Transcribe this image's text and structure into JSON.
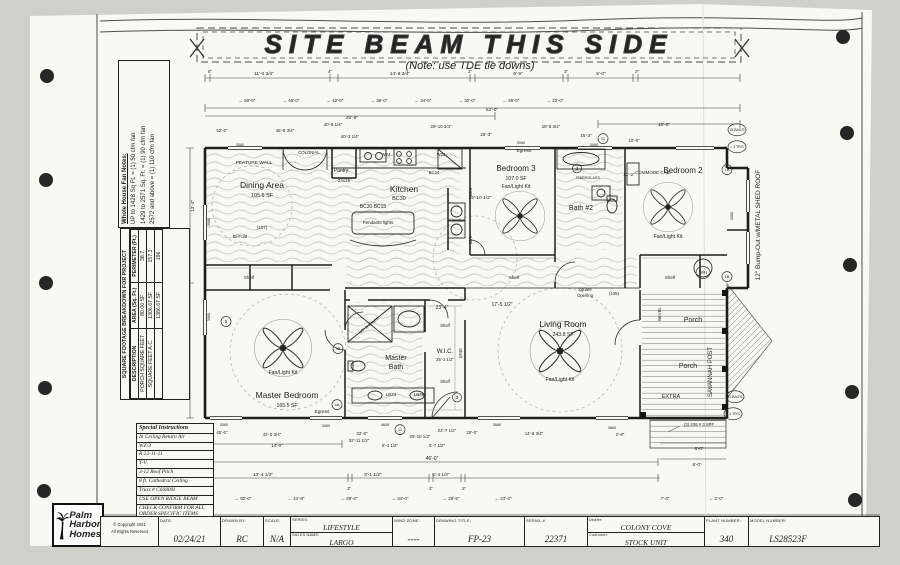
{
  "banner": {
    "title": "SITE BEAM THIS SIDE",
    "note": "(Note: use TDE tie downs)"
  },
  "fan_notes": {
    "title": "Whole House Fan Notes:",
    "line1": "UP to 1428 Sq Ft. = (1) 50 cfm fan",
    "line2": "1429 to 2571 Sq. Ft. = (1) 90 cfm fan",
    "line3": "2572 and above = (1) 110 cfm fan"
  },
  "sqft_table": {
    "title": "SQUARE FOOTAGE BREAKDOWN FOR PROJECT",
    "col1": "DESCRIPTION",
    "col2": "AREA (Sq. Ft.)",
    "col3": "PERIMETER (Ft.)",
    "r1c1": "PORCH SQUARE FEET",
    "r1c2": "80.00 SF",
    "r1c3": "38.7",
    "r2c1": "SQUARE FEET A.C.",
    "r2c2": "1306.67 SF",
    "r2c3": "157.3",
    "r3c1": "",
    "r3c2": "1386.67 SF",
    "r3c3": "196"
  },
  "special_instructions": {
    "title": "Special Instructions",
    "i1": "In Ceiling Return Air",
    "i2": "WZ-3",
    "i3": "R 22-11-11",
    "i4": "T-V",
    "i5": "3-12 Roof Pitch",
    "i6": "8 ft. Cathedral Ceiling",
    "i7": "Truss # C66800I",
    "i8": "USE OPEN RIDGE BEAM",
    "i9": "CHECK CONFIRM FOR ALL ORDER SPECIFIC ITEMS"
  },
  "logo": {
    "l1": "Palm",
    "l2": "Harbor",
    "l3": "Homes"
  },
  "copyright": {
    "l1": "© Copyright 2021",
    "l2": "All Rights Reserved"
  },
  "title_block": {
    "date_label": "DATE:",
    "date": "02/24/21",
    "drawn_label": "DRAWN BY:",
    "drawn": "RC",
    "scale_label": "SCALE:",
    "scale": "N/A",
    "series_label": "SERIES:",
    "series": "LIFESTYLE",
    "sales_label": "SALES NAME:",
    "sales": "LARGO",
    "wind_label": "WIND ZONE:",
    "wind": "----",
    "dtitle_label": "DRAWING TITLE:",
    "dtitle": "FP-23",
    "serial_label": "SERIAL #",
    "serial": "22371",
    "dealer_label": "Dealer:",
    "dealer": "COLONY COVE",
    "customer_label": "Customer:",
    "customer": "STOCK UNIT",
    "plant_label": "PLANT NUMBER:",
    "plant": "340",
    "model_label": "MODEL NUMBER:",
    "model": "LS28523F"
  },
  "plan_labels": [
    {
      "t": "Dining Area",
      "x": 262,
      "y": 188,
      "s": 8.5
    },
    {
      "t": "105.6 SF",
      "x": 262,
      "y": 197,
      "s": 5.5
    },
    {
      "t": "FEATURE WALL",
      "x": 254,
      "y": 164,
      "s": 4.8
    },
    {
      "t": "COLONIAL",
      "x": 309,
      "y": 154,
      "s": 4.2
    },
    {
      "t": "Pantry",
      "x": 341,
      "y": 172,
      "s": 5
    },
    {
      "t": "Kitchen",
      "x": 404,
      "y": 192,
      "s": 8.5
    },
    {
      "t": "BC30",
      "x": 399,
      "y": 200,
      "s": 5.5
    },
    {
      "t": "BC30 BC15",
      "x": 373,
      "y": 208,
      "s": 5
    },
    {
      "t": "Pendants lights",
      "x": 378,
      "y": 224,
      "s": 4.5
    },
    {
      "t": "24x26",
      "x": 344,
      "y": 182,
      "s": 4.5
    },
    {
      "t": "W24",
      "x": 386,
      "y": 156,
      "s": 4.2
    },
    {
      "t": "W24",
      "x": 441,
      "y": 156,
      "s": 4.2
    },
    {
      "t": "BC24",
      "x": 434,
      "y": 174,
      "s": 4.2
    },
    {
      "t": "W30",
      "x": 469,
      "y": 192,
      "s": 4.2,
      "r": 90
    },
    {
      "t": "W30",
      "x": 469,
      "y": 240,
      "s": 4.2,
      "r": 90
    },
    {
      "t": "Bi-Fold",
      "x": 240,
      "y": 238,
      "s": 4.5
    },
    {
      "t": "(107)",
      "x": 262,
      "y": 229,
      "s": 4.5
    },
    {
      "t": "Egress",
      "x": 524,
      "y": 152,
      "s": 4.8
    },
    {
      "t": "Bedroom 3",
      "x": 516,
      "y": 171,
      "s": 8
    },
    {
      "t": "107.0 SF",
      "x": 516,
      "y": 180,
      "s": 5.2
    },
    {
      "t": "Fan/Light Kit",
      "x": 516,
      "y": 188,
      "s": 5.2
    },
    {
      "t": "Bath #2",
      "x": 581,
      "y": 210,
      "s": 7
    },
    {
      "t": "2",
      "x": 577,
      "y": 170,
      "s": 4.5,
      "c": 4.5
    },
    {
      "t": "FIBERGLASS",
      "x": 588,
      "y": 179,
      "s": 3.8
    },
    {
      "t": "COMMODE CAB.",
      "x": 653,
      "y": 174,
      "s": 4.5
    },
    {
      "t": "Bedroom 2",
      "x": 683,
      "y": 173,
      "s": 8
    },
    {
      "t": "Fan/Light Kit",
      "x": 668,
      "y": 238,
      "s": 5.2
    },
    {
      "t": "Shelf",
      "x": 249,
      "y": 279,
      "s": 4.5
    },
    {
      "t": "Shelf",
      "x": 514,
      "y": 279,
      "s": 4.5
    },
    {
      "t": "Shelf",
      "x": 670,
      "y": 279,
      "s": 4.5
    },
    {
      "t": "W/H",
      "x": 703,
      "y": 274,
      "s": 4.2,
      "c": 7
    },
    {
      "t": "Master Bedroom",
      "x": 287,
      "y": 398,
      "s": 8.5
    },
    {
      "t": "165.5 SF",
      "x": 287,
      "y": 407,
      "s": 5.2
    },
    {
      "t": "Fan/Light Kit",
      "x": 283,
      "y": 374,
      "s": 5.2
    },
    {
      "t": "Egress",
      "x": 322,
      "y": 413,
      "s": 4.8
    },
    {
      "t": "Master",
      "x": 396,
      "y": 360,
      "s": 7
    },
    {
      "t": "Bath",
      "x": 396,
      "y": 369,
      "s": 7
    },
    {
      "t": "60\" SHOWER",
      "x": 370,
      "y": 326,
      "s": 3.8,
      "r": -38
    },
    {
      "t": "LB24",
      "x": 391,
      "y": 396,
      "s": 4.5
    },
    {
      "t": "LB36",
      "x": 419,
      "y": 396,
      "s": 4.5
    },
    {
      "t": "W.I.C.",
      "x": 445,
      "y": 353,
      "s": 6
    },
    {
      "t": "25'-1 1/2\"",
      "x": 445,
      "y": 361,
      "s": 4.2
    },
    {
      "t": "Shelf",
      "x": 445,
      "y": 327,
      "s": 4.2
    },
    {
      "t": "Shelf",
      "x": 445,
      "y": 383,
      "s": 4.2
    },
    {
      "t": "Shelf",
      "x": 459,
      "y": 353,
      "s": 4.2,
      "r": 90
    },
    {
      "t": "Living Room",
      "x": 563,
      "y": 327,
      "s": 8.5
    },
    {
      "t": "243.8 SF",
      "x": 563,
      "y": 336,
      "s": 5.2
    },
    {
      "t": "Fan/Light Kit",
      "x": 560,
      "y": 381,
      "s": 5.2
    },
    {
      "t": "Square",
      "x": 585,
      "y": 291,
      "s": 4.2
    },
    {
      "t": "Opening",
      "x": 585,
      "y": 297,
      "s": 4.2
    },
    {
      "t": "(105)",
      "x": 614,
      "y": 295,
      "s": 4.2
    },
    {
      "t": "Porch",
      "x": 693,
      "y": 322,
      "s": 7
    },
    {
      "t": "Porch",
      "x": 688,
      "y": 368,
      "s": 7
    },
    {
      "t": "SAVANNAH POST",
      "x": 712,
      "y": 372,
      "s": 6,
      "r": -90
    },
    {
      "t": "BEVEL",
      "x": 661,
      "y": 314,
      "s": 4.2,
      "r": -90
    },
    {
      "t": "EXTRA",
      "x": 671,
      "y": 398,
      "s": 5.5
    },
    {
      "t": "12\" Bump-Out w/METAL SHED ROOF",
      "x": 760,
      "y": 225,
      "s": 6.5,
      "r": -90
    },
    {
      "t": "(3) 2X6 # 3 SPF",
      "x": 699,
      "y": 426,
      "s": 4.2
    },
    {
      "t": "15 BAG'S",
      "x": 737,
      "y": 131,
      "s": 3.5,
      "c": 9
    },
    {
      "t": "= 1 TR'S",
      "x": 737,
      "y": 148,
      "s": 3.5,
      "c": 9
    },
    {
      "t": "11 BAG'S",
      "x": 735,
      "y": 398,
      "s": 3.5,
      "c": 9
    },
    {
      "t": "= 1 TR'S",
      "x": 733,
      "y": 415,
      "s": 3.5,
      "c": 9
    },
    {
      "t": "1A",
      "x": 727,
      "y": 171,
      "s": 4,
      "c": 5
    },
    {
      "t": "1B",
      "x": 727,
      "y": 278,
      "s": 4,
      "c": 5
    },
    {
      "t": "5",
      "x": 226,
      "y": 323,
      "s": 4.5,
      "c": 5
    },
    {
      "t": "4B",
      "x": 338,
      "y": 350,
      "s": 4,
      "c": 5
    },
    {
      "t": "4A",
      "x": 337,
      "y": 406,
      "s": 4,
      "c": 5
    },
    {
      "t": "3",
      "x": 457,
      "y": 399,
      "s": 4.5,
      "c": 4.5
    },
    {
      "t": "11",
      "x": 603,
      "y": 140,
      "s": 4,
      "c": 5
    },
    {
      "t": "11",
      "x": 400,
      "y": 431,
      "s": 4,
      "c": 5
    },
    {
      "t": "6\"",
      "x": 210,
      "y": 73,
      "s": 4.2
    },
    {
      "t": "11'-0 3/4\"",
      "x": 264,
      "y": 75,
      "s": 4.8
    },
    {
      "t": "4\"",
      "x": 330,
      "y": 73,
      "s": 4.2
    },
    {
      "t": "14'-8 3/4\"",
      "x": 400,
      "y": 75,
      "s": 4.8
    },
    {
      "t": "3\"",
      "x": 470,
      "y": 73,
      "s": 4.2
    },
    {
      "t": "9'-9\"",
      "x": 518,
      "y": 75,
      "s": 4.8
    },
    {
      "t": "3\"",
      "x": 566,
      "y": 73,
      "s": 4.2
    },
    {
      "t": "5'-0\"",
      "x": 601,
      "y": 75,
      "s": 4.8
    },
    {
      "t": "3\"",
      "x": 637,
      "y": 73,
      "s": 4.2
    },
    {
      "t": "← 50'-0\"",
      "x": 247,
      "y": 102,
      "s": 4.4
    },
    {
      "t": "← 46'-0\"",
      "x": 291,
      "y": 102,
      "s": 4.4
    },
    {
      "t": "← 42'-0\"",
      "x": 335,
      "y": 102,
      "s": 4.4
    },
    {
      "t": "← 38'-0\"",
      "x": 379,
      "y": 102,
      "s": 4.4
    },
    {
      "t": "← 34'-0\"",
      "x": 423,
      "y": 102,
      "s": 4.4
    },
    {
      "t": "← 30'-0\"",
      "x": 467,
      "y": 102,
      "s": 4.4
    },
    {
      "t": "← 26'-0\"",
      "x": 511,
      "y": 102,
      "s": 4.4
    },
    {
      "t": "← 22'-0\"",
      "x": 555,
      "y": 102,
      "s": 4.4
    },
    {
      "t": "52'-0\"",
      "x": 492,
      "y": 111,
      "s": 4.8
    },
    {
      "t": "26'-9\"",
      "x": 352,
      "y": 119,
      "s": 4.8
    },
    {
      "t": "10'-0\"",
      "x": 664,
      "y": 126,
      "s": 4.8
    },
    {
      "t": "52'-0\"",
      "x": 222,
      "y": 132,
      "s": 4.4
    },
    {
      "t": "46'-8 3/4\"",
      "x": 285,
      "y": 132,
      "s": 4.4
    },
    {
      "t": "40'-9 1/4\"",
      "x": 333,
      "y": 126,
      "s": 4.4
    },
    {
      "t": "40'-3 1/4\"",
      "x": 350,
      "y": 138,
      "s": 4.4
    },
    {
      "t": "29'-10 3/4\"",
      "x": 441,
      "y": 128,
      "s": 4.4
    },
    {
      "t": "25'-3\"",
      "x": 486,
      "y": 136,
      "s": 4.4
    },
    {
      "t": "18'-8 3/4\"",
      "x": 551,
      "y": 128,
      "s": 4.4
    },
    {
      "t": "15'-3\"",
      "x": 586,
      "y": 137,
      "s": 4.4
    },
    {
      "t": "10'-0\"",
      "x": 634,
      "y": 142,
      "s": 4.4
    },
    {
      "t": "25'-10 1/2\"",
      "x": 480,
      "y": 199,
      "s": 4.8
    },
    {
      "t": "11'-2\"",
      "x": 629,
      "y": 176,
      "s": 4.8
    },
    {
      "t": "17'-5 1/2\"",
      "x": 502,
      "y": 306,
      "s": 5
    },
    {
      "t": "23'-4\"",
      "x": 442,
      "y": 309,
      "s": 5
    },
    {
      "t": "13'-4\"",
      "x": 194,
      "y": 206,
      "s": 4.4,
      "r": -90
    },
    {
      "t": "26'-8\"",
      "x": 186,
      "y": 253,
      "s": 4.4,
      "r": -90
    },
    {
      "t": "3060",
      "x": 240,
      "y": 146,
      "s": 3.8
    },
    {
      "t": "3060",
      "x": 521,
      "y": 144,
      "s": 3.8
    },
    {
      "t": "3060",
      "x": 594,
      "y": 146,
      "s": 3.8
    },
    {
      "t": "3060",
      "x": 210,
      "y": 222,
      "s": 3.8,
      "r": -90
    },
    {
      "t": "3060",
      "x": 210,
      "y": 317,
      "s": 3.8,
      "r": -90
    },
    {
      "t": "3060",
      "x": 733,
      "y": 216,
      "s": 3.8,
      "r": -90
    },
    {
      "t": "3060",
      "x": 224,
      "y": 426,
      "s": 3.8
    },
    {
      "t": "3060",
      "x": 326,
      "y": 427,
      "s": 3.8
    },
    {
      "t": "4608",
      "x": 385,
      "y": 426,
      "s": 3.8
    },
    {
      "t": "3660",
      "x": 497,
      "y": 426,
      "s": 3.8
    },
    {
      "t": "3660",
      "x": 612,
      "y": 429,
      "s": 3.8
    },
    {
      "t": "45'-0\"",
      "x": 222,
      "y": 434,
      "s": 4.4
    },
    {
      "t": "42'-0 3/4\"",
      "x": 272,
      "y": 436,
      "s": 4.4
    },
    {
      "t": "32'-0\"",
      "x": 362,
      "y": 435,
      "s": 4.4
    },
    {
      "t": "32'-11 1/2\"",
      "x": 359,
      "y": 442,
      "s": 4.4
    },
    {
      "t": "6'-4 1/2\"",
      "x": 390,
      "y": 447,
      "s": 4.4
    },
    {
      "t": "25'-10 1/2\"",
      "x": 420,
      "y": 438,
      "s": 4.4
    },
    {
      "t": "23'-7 1/2\"",
      "x": 447,
      "y": 432,
      "s": 4.4
    },
    {
      "t": "5'-7 1/2\"",
      "x": 437,
      "y": 447,
      "s": 4.4
    },
    {
      "t": "20'-0\"",
      "x": 472,
      "y": 434,
      "s": 4.4
    },
    {
      "t": "14'-8 3/4\"",
      "x": 534,
      "y": 435,
      "s": 4.4
    },
    {
      "t": "2'-8\"",
      "x": 620,
      "y": 436,
      "s": 4.4
    },
    {
      "t": "14'-0\"",
      "x": 277,
      "y": 447,
      "s": 4.4
    },
    {
      "t": "46'-0\"",
      "x": 432,
      "y": 460,
      "s": 5
    },
    {
      "t": "13'-4 1/2\"",
      "x": 263,
      "y": 476,
      "s": 4.8
    },
    {
      "t": "8'-1 1/2\"",
      "x": 373,
      "y": 476,
      "s": 4.8
    },
    {
      "t": "5'-4 1/2\"",
      "x": 441,
      "y": 476,
      "s": 4.8
    },
    {
      "t": "6\"",
      "x": 203,
      "y": 490,
      "s": 4.2
    },
    {
      "t": "3\"",
      "x": 349,
      "y": 490,
      "s": 4.2
    },
    {
      "t": "3\"",
      "x": 431,
      "y": 490,
      "s": 4.2
    },
    {
      "t": "3\"",
      "x": 464,
      "y": 490,
      "s": 4.2
    },
    {
      "t": "← 50'-0\"",
      "x": 243,
      "y": 500,
      "s": 4.4
    },
    {
      "t": "← 44'-8\"",
      "x": 296,
      "y": 500,
      "s": 4.4
    },
    {
      "t": "← 39'-4\"",
      "x": 349,
      "y": 500,
      "s": 4.4
    },
    {
      "t": "← 34'-0\"",
      "x": 400,
      "y": 500,
      "s": 4.4
    },
    {
      "t": "← 28'-8\"",
      "x": 451,
      "y": 500,
      "s": 4.4
    },
    {
      "t": "← 23'-4\"",
      "x": 503,
      "y": 500,
      "s": 4.4
    },
    {
      "t": "7'-4\"",
      "x": 665,
      "y": 500,
      "s": 4.4
    },
    {
      "t": "← 2'-0\"",
      "x": 716,
      "y": 500,
      "s": 4.4
    },
    {
      "t": "6'-0\"",
      "x": 699,
      "y": 450,
      "s": 4.4
    },
    {
      "t": "6'-0\"",
      "x": 697,
      "y": 466,
      "s": 4.4
    }
  ]
}
